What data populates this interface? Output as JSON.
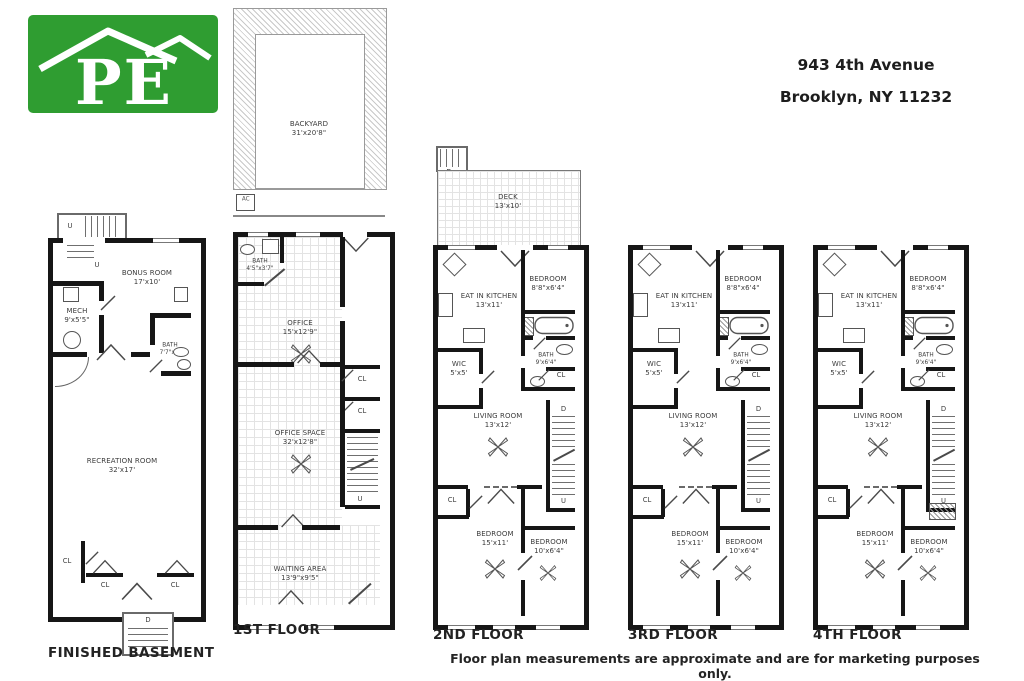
{
  "header": {
    "address_line1": "943 4th Avenue",
    "address_line2": "Brooklyn, NY 11232"
  },
  "logo": {
    "text": "PE",
    "brand_color": "#2f9d31"
  },
  "footer": {
    "disclaimer": "Floor plan measurements are approximate and are for marketing purposes only."
  },
  "markers": {
    "closet": "CL",
    "down": "D",
    "up": "U",
    "ac": "AC"
  },
  "floors": {
    "basement": {
      "title": "FINISHED BASEMENT",
      "rooms": {
        "bonus": {
          "name": "BONUS ROOM",
          "dims": "17'x10'"
        },
        "mech": {
          "name": "MECH",
          "dims": "9'x5'5\""
        },
        "bath": {
          "name": "BATH",
          "dims": "7'7\"x5'"
        },
        "recreation": {
          "name": "RECREATION ROOM",
          "dims": "32'x17'"
        }
      }
    },
    "first": {
      "title": "1ST FLOOR",
      "rooms": {
        "backyard": {
          "name": "BACKYARD",
          "dims": "31'x20'8\""
        },
        "bath": {
          "name": "BATH",
          "dims": "4'5\"x3'7\""
        },
        "office": {
          "name": "OFFICE",
          "dims": "15'x12'9\""
        },
        "office_space": {
          "name": "OFFICE SPACE",
          "dims": "32'x12'8\""
        },
        "waiting": {
          "name": "WAITING AREA",
          "dims": "13'9\"x9'5\""
        }
      }
    },
    "second": {
      "title": "2ND FLOOR",
      "deck": {
        "name": "DECK",
        "dims": "13'x10'"
      }
    },
    "third": {
      "title": "3RD FLOOR"
    },
    "fourth": {
      "title": "4TH FLOOR"
    }
  },
  "unit": {
    "eat_in_kitchen": {
      "name": "EAT IN KITCHEN",
      "dims": "13'x11'"
    },
    "bedroom_front": {
      "name": "BEDROOM",
      "dims": "8'8\"x6'4\""
    },
    "wic": {
      "name": "WIC",
      "dims": "5'x5'"
    },
    "bath": {
      "name": "BATH",
      "dims": "9'x6'4\""
    },
    "living_room": {
      "name": "LIVING ROOM",
      "dims": "13'x12'"
    },
    "bedroom_large": {
      "name": "BEDROOM",
      "dims": "15'x11'"
    },
    "bedroom_rear": {
      "name": "BEDROOM",
      "dims": "10'x6'4\""
    }
  }
}
